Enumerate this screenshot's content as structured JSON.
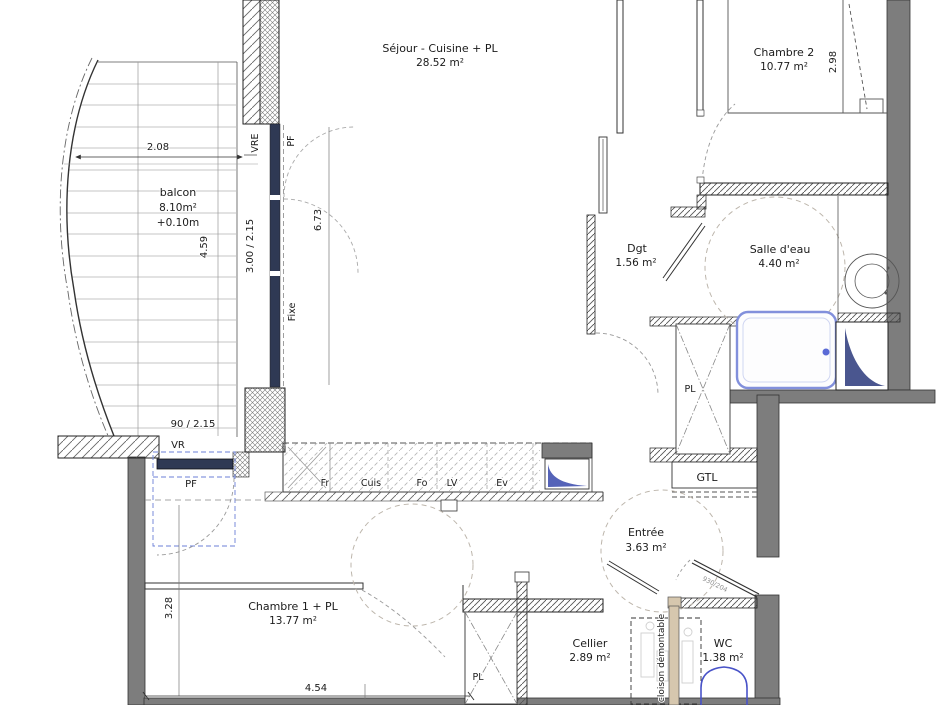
{
  "rooms": {
    "sejour": {
      "name": "Séjour - Cuisine + PL",
      "area": "28.52 m²"
    },
    "chambre2": {
      "name": "Chambre 2",
      "area": "10.77 m²"
    },
    "balcon": {
      "name": "balcon",
      "area": "8.10m²",
      "offset": "+0.10m"
    },
    "dgt": {
      "name": "Dgt",
      "area": "1.56 m²"
    },
    "salle_eau": {
      "name": "Salle d'eau",
      "area": "4.40 m²"
    },
    "entree": {
      "name": "Entrée",
      "area": "3.63 m²"
    },
    "chambre1": {
      "name": "Chambre 1 + PL",
      "area": "13.77 m²"
    },
    "cellier": {
      "name": "Cellier",
      "area": "2.89 m²"
    },
    "wc": {
      "name": "WC",
      "area": "1.38 m²"
    }
  },
  "dimensions": {
    "balcon_width": "2.08",
    "balcon_height": "4.59",
    "bay_window": "3.00 / 2.15",
    "sejour_window_height": "6.73",
    "chambre2_depth": "2.98",
    "pf_window": "90 / 2.15",
    "chambre1_depth": "3.28",
    "chambre1_width": "4.54"
  },
  "labels": {
    "vre": "VRE",
    "pf_bay": "PF",
    "fixe": "Fixe",
    "vr": "VR",
    "pf_small": "PF",
    "fr": "Fr",
    "cuis": "Cuis",
    "fo": "Fo",
    "lv": "LV",
    "ev": "Ev",
    "pl_bath": "PL",
    "gtl": "GTL",
    "pl_bedroom": "PL",
    "cloison": "cloison démontable",
    "door_ref": "930/204"
  },
  "colors": {
    "wall_gray": "#7d7d7d",
    "window_navy": "#2f3954",
    "fixture_blue": "#4953c8",
    "shower_blue": "#8290dc",
    "duct_navy": "#4a568f",
    "partition_tan": "#d6c7ae",
    "clearance_dash_blue": "#6b7fd7"
  }
}
